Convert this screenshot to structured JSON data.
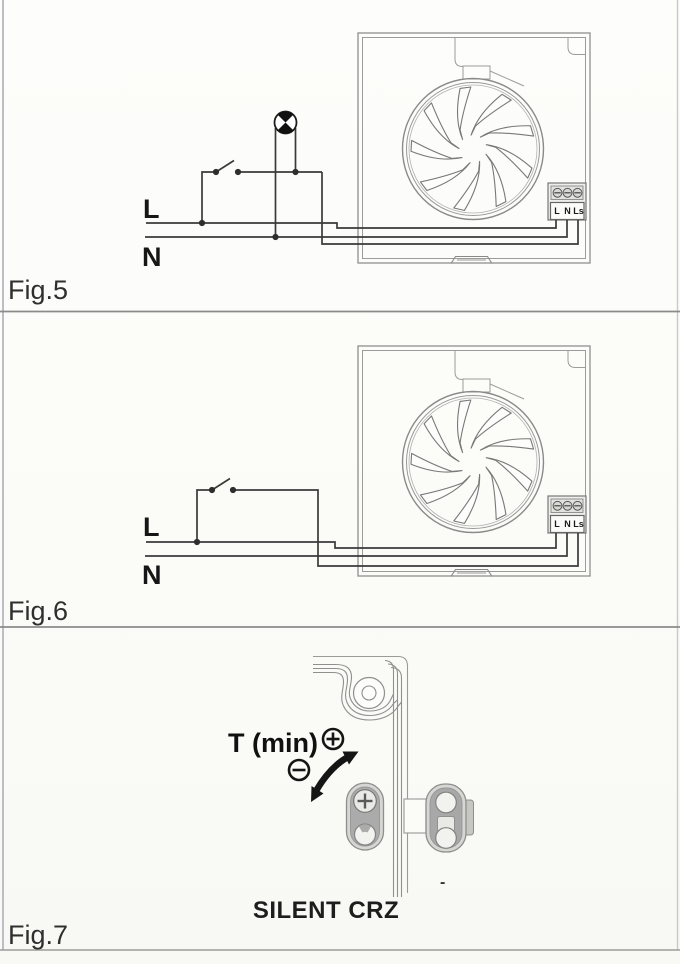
{
  "page": {
    "type": "installation-manual-wiring-diagrams",
    "background_color": "#fdfdfb",
    "line_color": "#3a3a3a",
    "outline_color": "#8f8f8f",
    "panel_divider_color": "#8b8b8b"
  },
  "figures": {
    "fig5": {
      "caption": "Fig.5",
      "live_label": "L",
      "neutral_label": "N",
      "terminal_labels": [
        "L",
        "N",
        "Ls"
      ],
      "components": [
        "fan-unit",
        "impeller",
        "terminal-block",
        "switch",
        "indicator-lamp"
      ]
    },
    "fig6": {
      "caption": "Fig.6",
      "live_label": "L",
      "neutral_label": "N",
      "terminal_labels": [
        "L",
        "N",
        "Ls"
      ],
      "components": [
        "fan-unit",
        "impeller",
        "terminal-block",
        "switch"
      ]
    },
    "fig7": {
      "caption": "Fig.7",
      "timer_label": "T (min)",
      "plus_icon": "circled-plus",
      "minus_icon": "circled-minus",
      "product_name": "SILENT CRZ",
      "dash": "-",
      "components": [
        "housing-corner",
        "screw-boss",
        "timer-potentiometer",
        "adjustment-arrow"
      ]
    }
  }
}
